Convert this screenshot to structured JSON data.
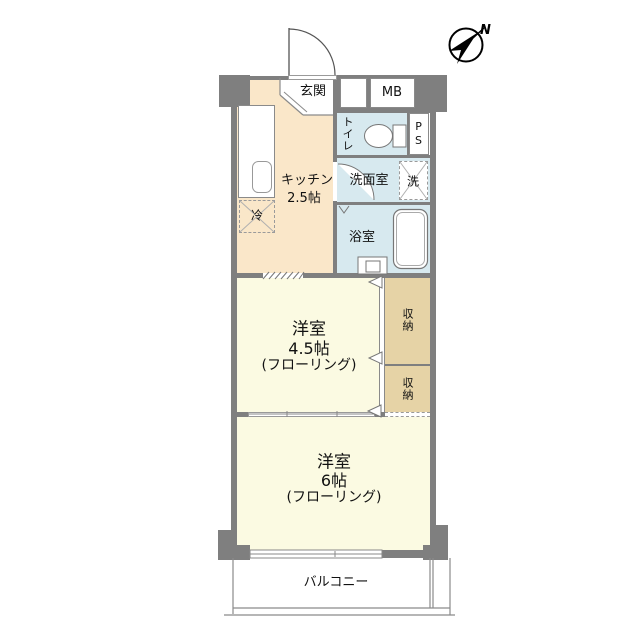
{
  "compass": {
    "north": "N"
  },
  "rooms": {
    "genkan": {
      "label": "玄関"
    },
    "meter_box": {
      "label": "MB"
    },
    "toilet": {
      "label": "トイレ"
    },
    "pipe_space": {
      "label": "PS"
    },
    "washroom": {
      "label": "洗面室"
    },
    "washer": {
      "label": "洗"
    },
    "kitchen": {
      "label": "キッチン",
      "size": "2.5帖"
    },
    "fridge": {
      "label": "冷"
    },
    "bathroom": {
      "label": "浴室"
    },
    "western_room_45": {
      "label": "洋室",
      "size": "4.5帖",
      "floor": "(フローリング)"
    },
    "closet_upper": {
      "label": "収納"
    },
    "closet_lower": {
      "label": "収納"
    },
    "western_room_6": {
      "label": "洋室",
      "size": "6帖",
      "floor": "(フローリング)"
    },
    "balcony": {
      "label": "バルコニー"
    }
  },
  "colors": {
    "wall": "#7f7f7f",
    "room_yellow": "#fbfae2",
    "service_cream": "#fae7c9",
    "wet_blue": "#d7e9ef",
    "closet_tan": "#e6d3a6",
    "white": "#ffffff"
  }
}
